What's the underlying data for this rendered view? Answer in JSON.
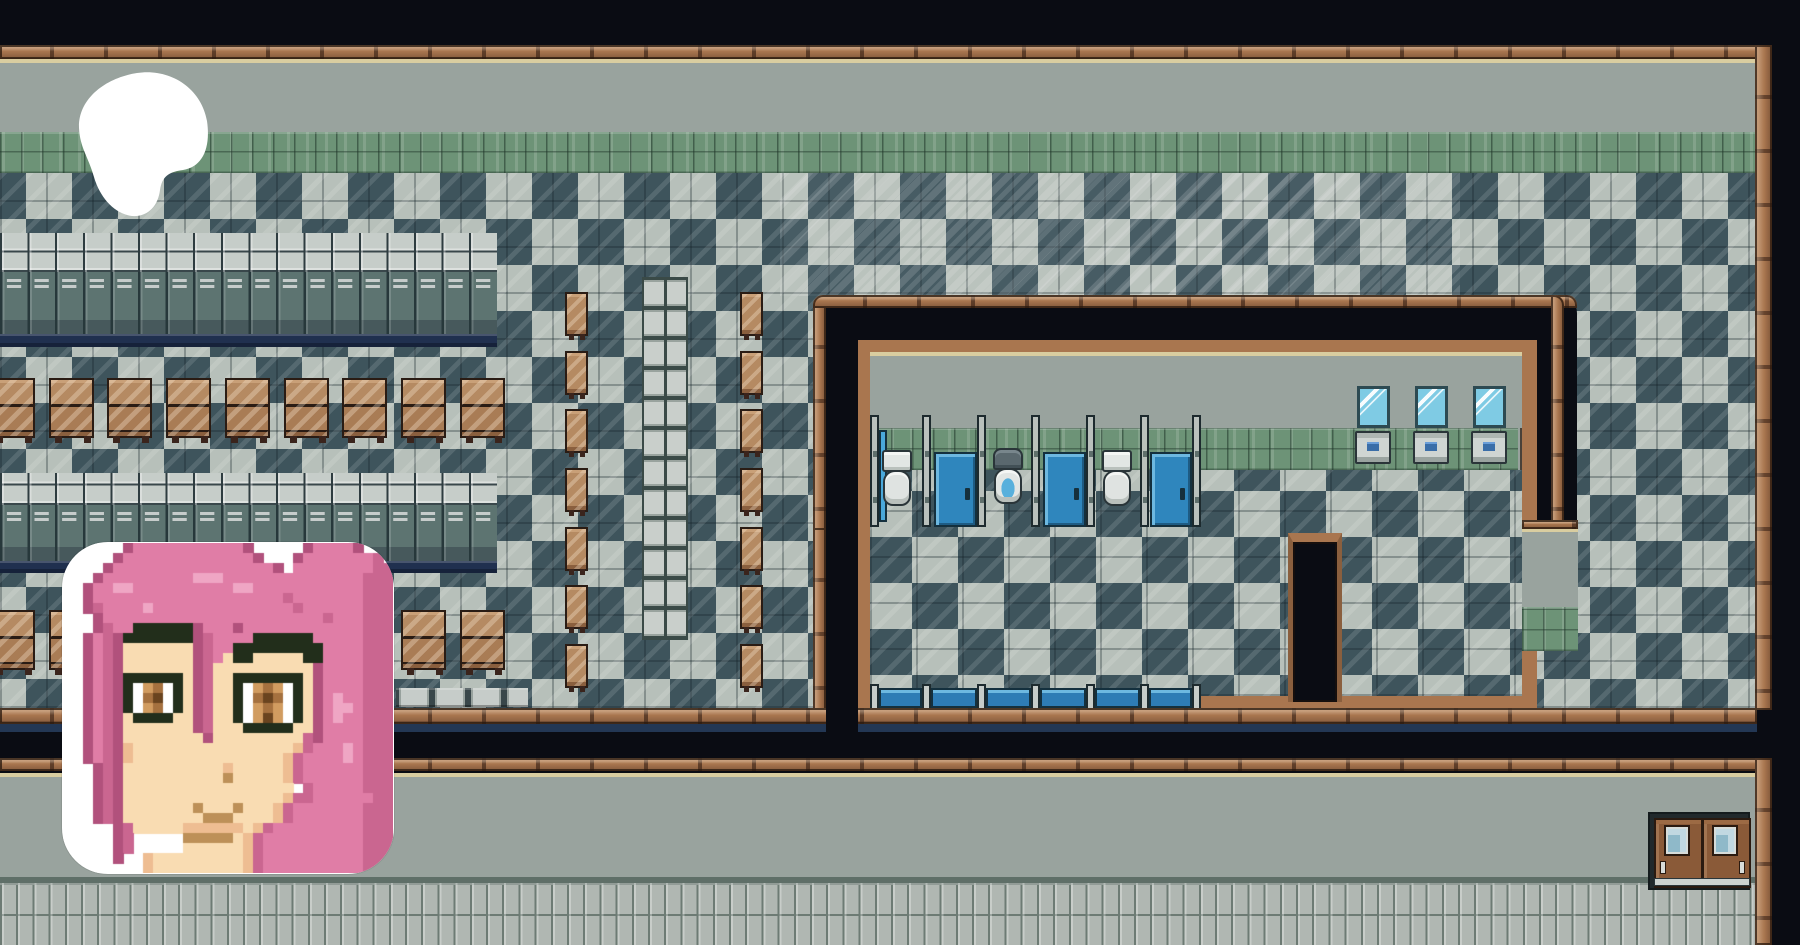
{
  "scene": {
    "title": "pixel-art school interior map",
    "style": "top-down RPG tilemap",
    "rooms": {
      "main_hall": {
        "floor": "diagonal checkerboard",
        "wall_top": "wood trim + gray wall + green tile band",
        "furniture": {
          "locker_rows": 2,
          "lockers_per_row": 18,
          "desk_rows": 2,
          "desks_per_row": 9,
          "vertical_desk_column_count": 7,
          "chair_column_count": 7,
          "glass_block_column_cells": 12,
          "bench_strip_cells": 4
        }
      },
      "bathroom": {
        "stall_dividers": 7,
        "closed_blue_doors": 3,
        "open_stalls_with_toilets": 3,
        "special_toilet_position": "middle open stall",
        "mirrors": 3,
        "sinks": 3,
        "south_stall_bars": 6,
        "entrance": "south-east green-tiled alcove"
      },
      "lower_hallway": {
        "double_door": {
          "leaves": 2,
          "windows": 2,
          "position": "bottom-right"
        }
      }
    },
    "colors": {
      "void": "#0a0c13",
      "wood": "#a9764f",
      "wood_dark": "#3a2216",
      "cream_trim": "#d9cda0",
      "wall_gray": "#99a39e",
      "green_tile": "#6d9377",
      "checker_light": "#b7c0ba",
      "checker_dark": "#3e545c",
      "locker_body": "#5d7471",
      "locker_base_navy": "#20304f",
      "desk_brown": "#b58a62",
      "stall_door_blue": "#2f86bd",
      "stall_bar_blue": "#2e7cb5",
      "mirror_blue": "#7fcbe4",
      "toilet_white": "#e2e6e4",
      "floor_tile_small": "#b0b7b2",
      "shadow_navy": "#233754"
    },
    "overlays": {
      "logo": {
        "name": "white-blob-logo",
        "color": "#ffffff"
      },
      "portrait": {
        "name": "pink-haired-character-avatar",
        "background": "#ffffff",
        "hair": "pink",
        "eyes": "brown"
      }
    }
  },
  "portrait": {
    "palette": {
      ".": "#ffffff",
      "o": "#b1517c",
      "p": "#e07da6",
      "d": "#ca6690",
      "h": "#efa6c4",
      "k": "#222e1b",
      "w": "#ffffff",
      "b": "#a5713f",
      "g": "#d19c60",
      "j": "#6a441f",
      "s": "#f9dcb2",
      "t": "#eebd92",
      "m": "#bd9058"
    },
    "rows": [
      "......opppppppppppo.....oppppo...",
      ".....opppppppppppppo...opppppppd.",
      "....oppppppppppppppppo.ppppppppdd",
      "...oppppppppphhhppppppppppppppddd",
      "..opphhpppppppppphhpppppppppppddd",
      "..opppppppppppppppppppdpppppppddd",
      "..odpppphppppppppppppppdppppppddd",
      "...oppppppppppppppppppppppdpppddd",
      "...odppkkkkkkopppoppppppppppppddd",
      "..opdokkkkkkkodppppkkkkkkpppppddd",
      "..opdosssssssodppkkkkkkkkkppppddd",
      "..opdosssssssodpskkssssskkppppddd",
      "..opdosssssssodssssssssssoppppddd",
      "..opdokkkkkksodsskkkkkkksoppppddd",
      "..opdokwgbwksodsskwgbgwksoppppddd",
      "..opdokwbjwksodsskwbjbwksophppddd",
      "..opdokwgbwksodsskwgbgwksophhpddd",
      "..opdoskkkkssodsskwgjgwksophppddd",
      "..opdosssssssodssskkkkkssoppppddd",
      "..opdossssssssosssssssssdoppppddd",
      "..opdotsssssssssssssssstdppphpddd",
      "..opdotssssssssssssssstdpppphpddd",
      "...odosssssssssstssssstdppppppddd",
      "...odossssssssssmssssstdppppppddd",
      "...odosssssssssssssssssтdpppppddd",
      "...odosssssssssssssssstddppppppddd",
      "...odosssssssmsssmssstdpppppppddd",
      "...odossssssssmmmsssstdpppppppddd",
      ".....odsssssttttttstdpppppppppddd",
      ".....od.....mmmmmstdppppppppppddd",
      ".....od.....sssssstdppppppppppddd",
      ".....o..tssssssssstdppppppppppddd",
      "........tssssssssstdppppppppppddd"
    ]
  }
}
